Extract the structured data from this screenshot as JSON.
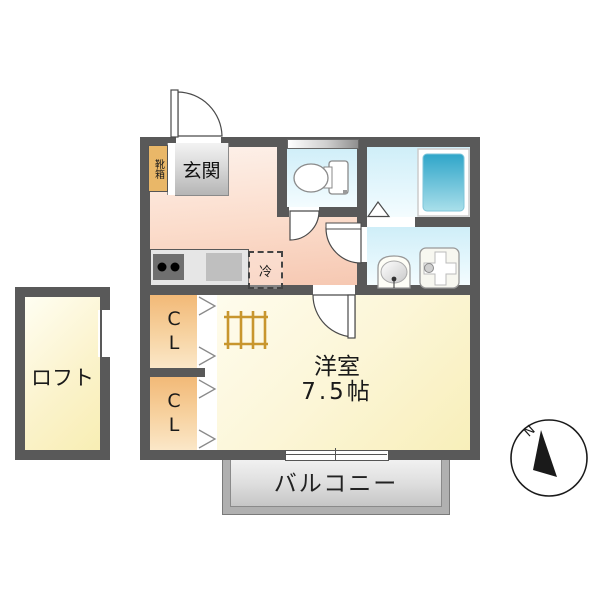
{
  "floorplan": {
    "title_hint": "1K apartment floor plan",
    "labels": {
      "genkan": "玄関",
      "shoebox": "靴箱",
      "fridge": "冷",
      "room_name": "洋室",
      "room_size": "7.5帖",
      "closet_upper": "CL",
      "closet_lower": "CL",
      "loft": "ロフト",
      "balcony": "バルコニー",
      "compass_north": "N"
    },
    "rooms": [
      {
        "name": "玄関"
      },
      {
        "name": "洋室",
        "size": "7.5帖"
      },
      {
        "name": "CL"
      },
      {
        "name": "CL"
      },
      {
        "name": "ロフト"
      },
      {
        "name": "バルコニー"
      }
    ],
    "colors": {
      "wall": "#595959",
      "kitchen_floor": "#f6c8b2",
      "wet_area_floor": "#cfeef8",
      "main_room_floor": "#f8efba",
      "closet": "#f2b977",
      "shoebox": "#e9b768",
      "bathtub": "#39a9cb",
      "balcony": "#c6c6c6",
      "ladder": "#c8962e"
    }
  }
}
